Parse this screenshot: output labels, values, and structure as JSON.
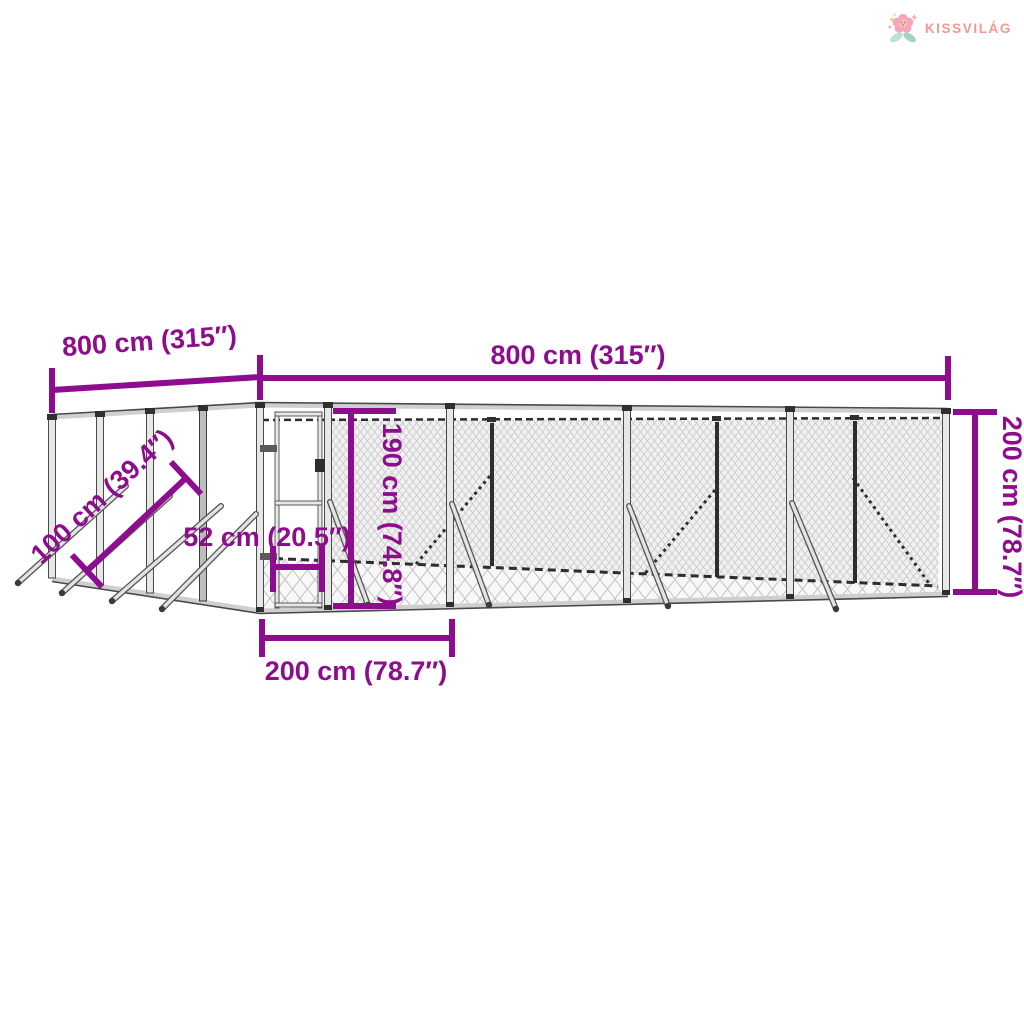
{
  "brand": {
    "name": "KISSVILÁG"
  },
  "colors": {
    "accent": "#8E0C8E",
    "brand": "#F09A90",
    "petal": "#F3A8BA",
    "flower_center": "#E98C53",
    "leaf": "#BEDFD2",
    "leaf_dark": "#A5D2C2",
    "sparkle": "#F6CD85"
  },
  "dimensions": {
    "side_length": "800 cm (315″)",
    "front_length": "800 cm (315″)",
    "total_height": "200 cm (78.7″)",
    "door_height": "190 cm (74.8″)",
    "door_width": "52 cm (20.5″)",
    "door_panel_width": "200 cm (78.7″)",
    "anchor_pole_length": "100 cm (39.4″)"
  }
}
